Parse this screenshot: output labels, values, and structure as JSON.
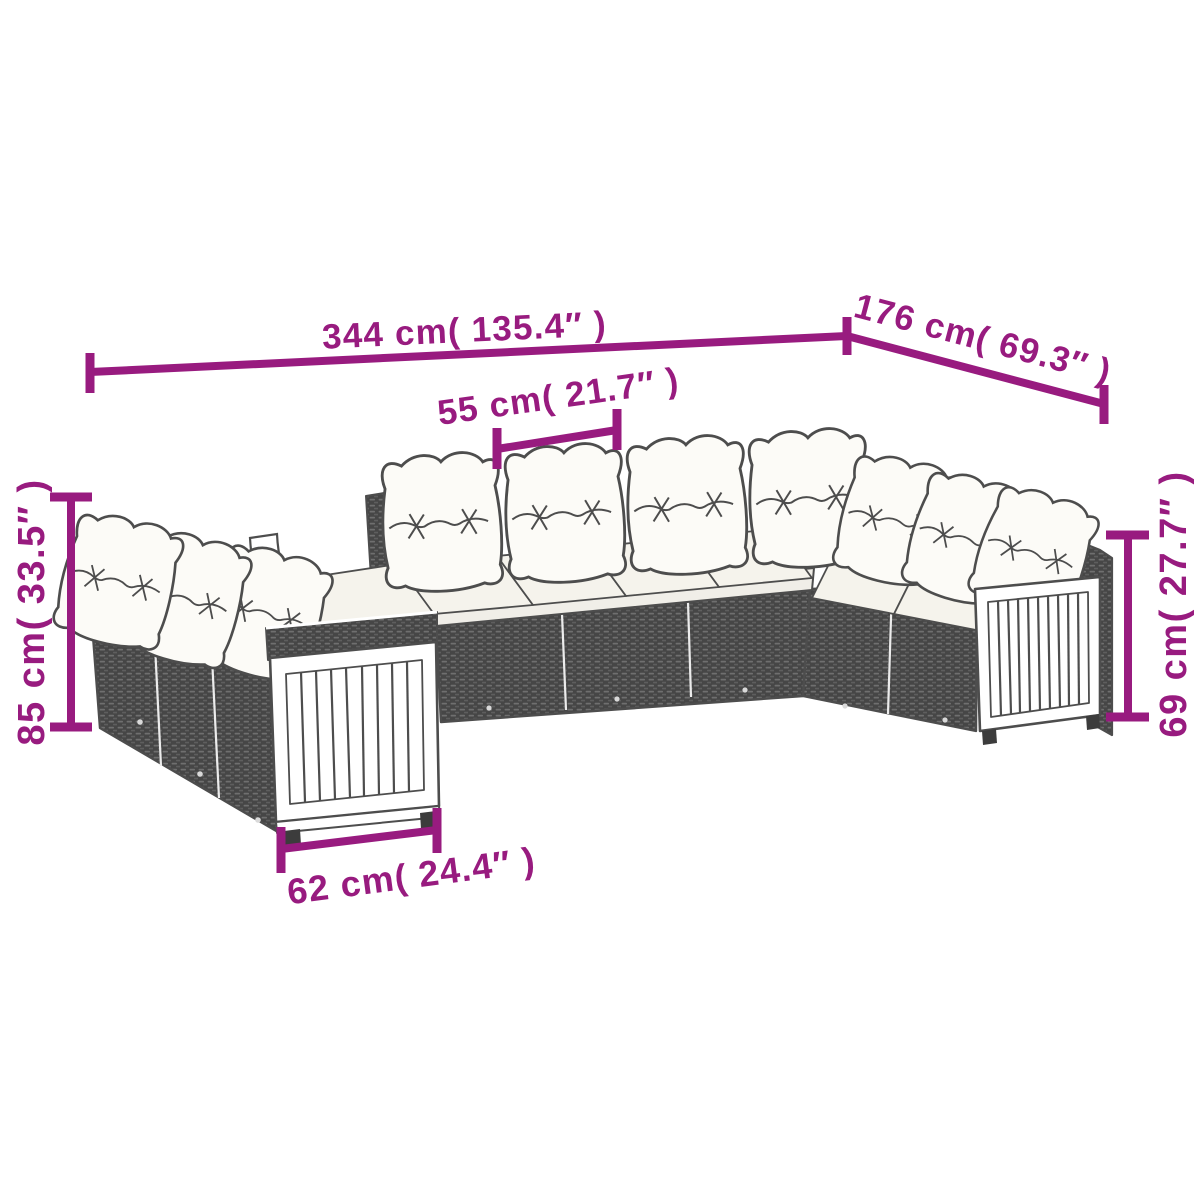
{
  "diagram": {
    "title": "Garden sofa set with cushions — dimension diagram",
    "product": "poly rattan modular lounge set with slatted wood arm panels",
    "colors": {
      "accent": "#981b7f",
      "line_art": "#4d4d4d",
      "rattan_dark": "#464646",
      "back_cushion": "#fcfbf7",
      "seat_cushion": "#f5f3ec",
      "background": "#ffffff"
    },
    "dimensions": {
      "total_width": {
        "label": "344 cm( 135.4″ )"
      },
      "right_wing_depth": {
        "label": "176 cm( 69.3″ )"
      },
      "seat_module": {
        "label": "55 cm( 21.7″ )"
      },
      "back_height": {
        "label": "85 cm( 33.5″ )"
      },
      "arm_height": {
        "label": "69 cm( 27.7″ )"
      },
      "arm_module": {
        "label": "62 cm( 24.4″ )"
      }
    }
  }
}
